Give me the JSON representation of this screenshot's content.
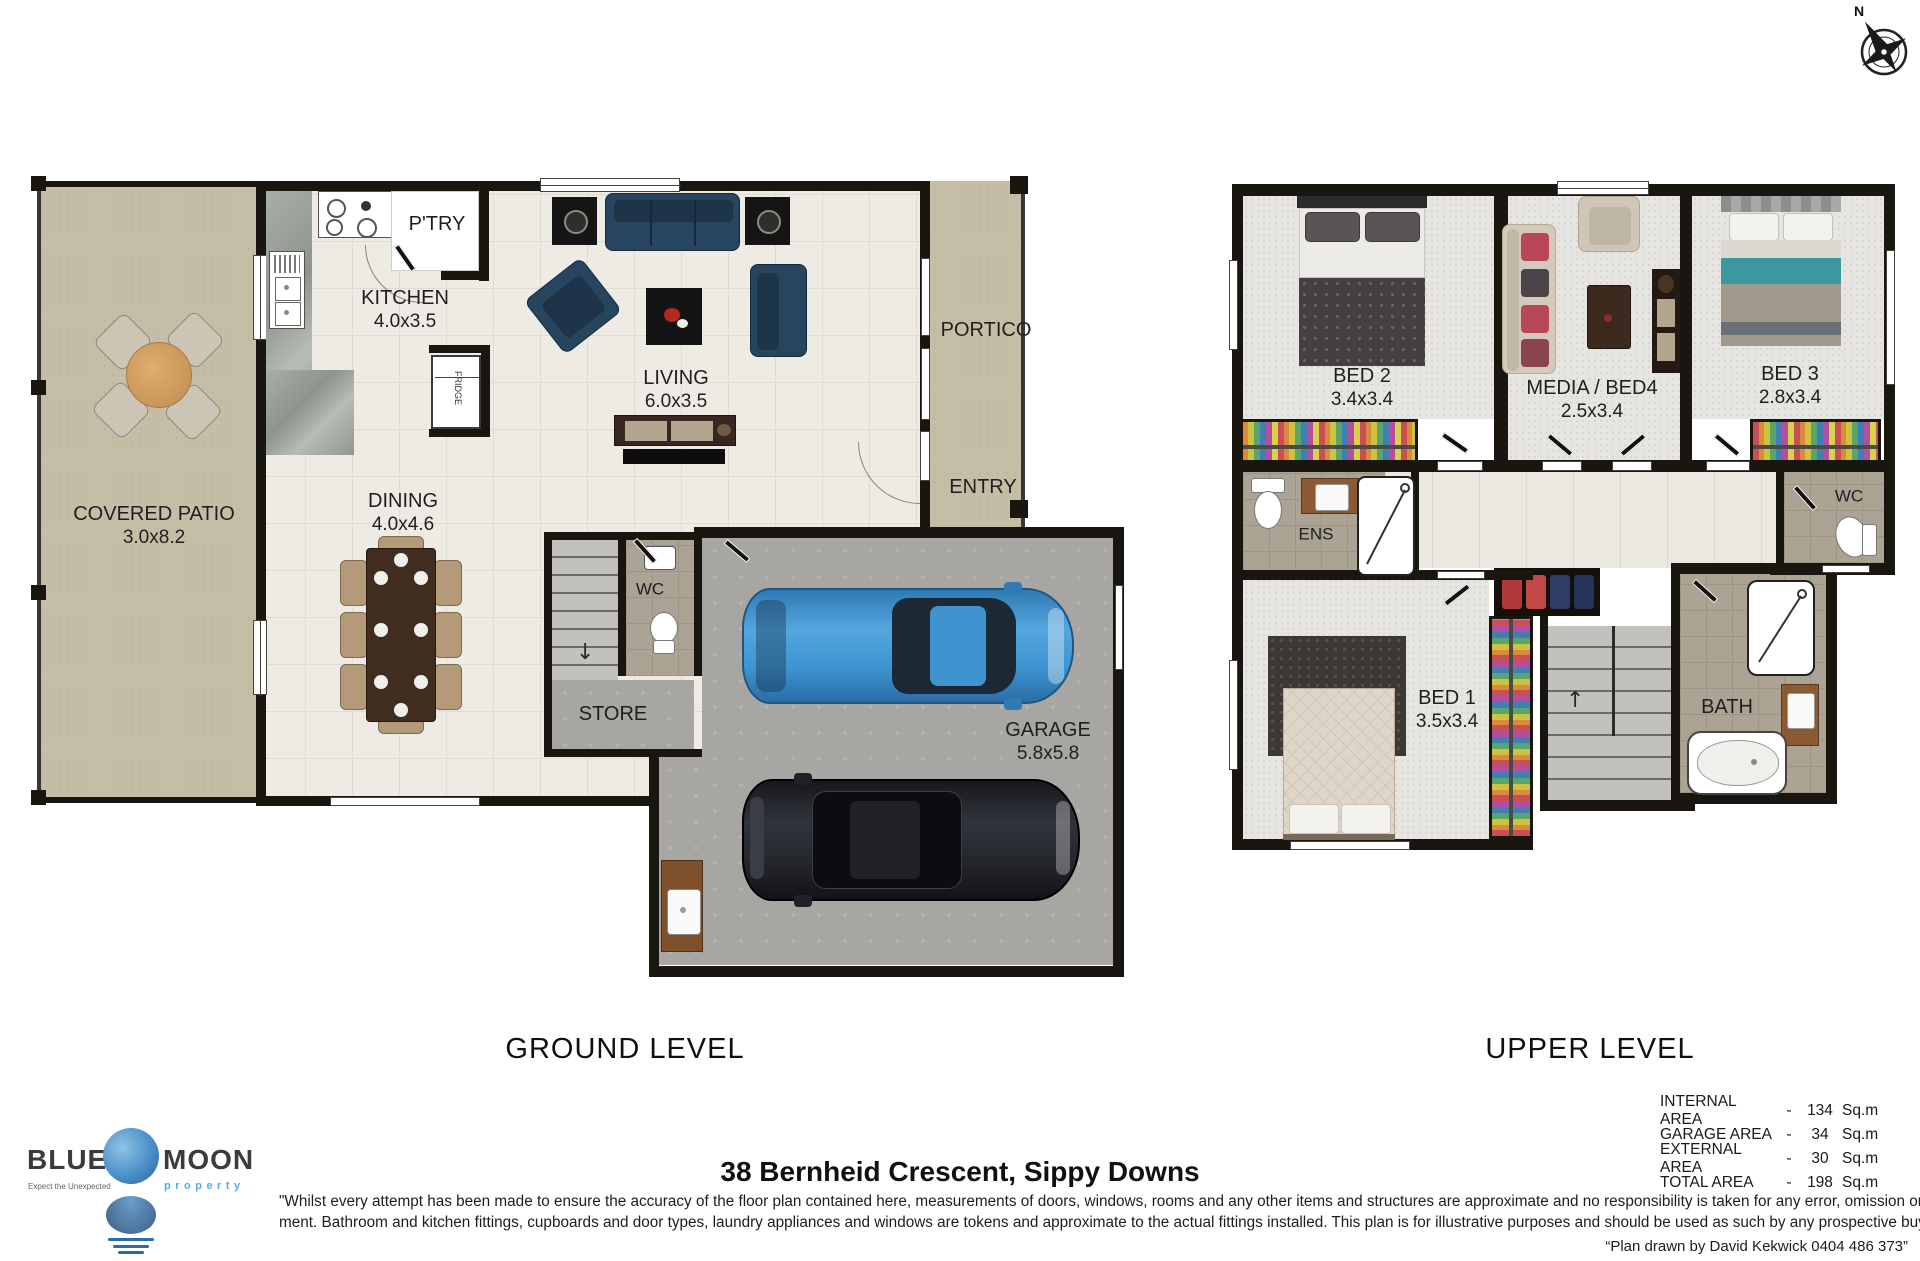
{
  "compass": {
    "north_label": "N"
  },
  "ground_level": {
    "title": "GROUND LEVEL",
    "rooms": {
      "patio": {
        "name": "COVERED PATIO",
        "dims": "3.0x8.2"
      },
      "kitchen": {
        "name": "KITCHEN",
        "dims": "4.0x3.5"
      },
      "pantry": {
        "name": "P'TRY"
      },
      "fridge": {
        "name": "FRIDGE"
      },
      "living": {
        "name": "LIVING",
        "dims": "6.0x3.5"
      },
      "dining": {
        "name": "DINING",
        "dims": "4.0x4.6"
      },
      "portico": {
        "name": "PORTICO"
      },
      "entry": {
        "name": "ENTRY"
      },
      "wc": {
        "name": "WC"
      },
      "store": {
        "name": "STORE"
      },
      "garage": {
        "name": "GARAGE",
        "dims": "5.8x5.8"
      }
    }
  },
  "upper_level": {
    "title": "UPPER LEVEL",
    "rooms": {
      "bed2": {
        "name": "BED 2",
        "dims": "3.4x3.4"
      },
      "media": {
        "name": "MEDIA / BED4",
        "dims": "2.5x3.4"
      },
      "bed3": {
        "name": "BED 3",
        "dims": "2.8x3.4"
      },
      "ens": {
        "name": "ENS"
      },
      "wc": {
        "name": "WC"
      },
      "bed1": {
        "name": "BED 1",
        "dims": "3.5x3.4"
      },
      "bath": {
        "name": "BATH"
      }
    }
  },
  "footer": {
    "logo": {
      "word1": "BLUE",
      "word2": "MOON",
      "sub": "property",
      "tagline": "Expect the Unexpected"
    },
    "address": "38 Bernheid Crescent, Sippy Downs",
    "disclaimer_line1": "\"Whilst every attempt has been made to ensure the accuracy of the floor plan contained here, measurements of doors, windows, rooms and any other items and structures are approximate and no responsibility is taken for any error, omission or mis-state-",
    "disclaimer_line2": "ment. Bathroom and kitchen fittings, cupboards and door types, laundry appliances and windows are tokens and approximate to the actual fittings installed. This plan is for illustrative purposes and should be used as such by any prospective buyer.\"",
    "credit": "“Plan drawn by David Kekwick 0404 486 373”",
    "areas": [
      {
        "label": "INTERNAL AREA",
        "sep": "-",
        "value": "134",
        "unit": "Sq.m"
      },
      {
        "label": "GARAGE AREA",
        "sep": "-",
        "value": "34",
        "unit": "Sq.m"
      },
      {
        "label": "EXTERNAL AREA",
        "sep": "-",
        "value": "30",
        "unit": "Sq.m"
      },
      {
        "label": "TOTAL AREA",
        "sep": "-",
        "value": "198",
        "unit": "Sq.m"
      }
    ]
  },
  "colors": {
    "wall": "#19150f",
    "patio_tan": "#c6bda6",
    "interior_cream": "#edebe4",
    "garage_concrete": "#a7a6a3",
    "upper_carpet": "#e6e5e2",
    "bathroom_tile": "#aba393",
    "sofa_navy": "#27455e",
    "car_blue": "#3f97d3",
    "car_black": "#24262c",
    "logo_blue": "#56aede"
  }
}
